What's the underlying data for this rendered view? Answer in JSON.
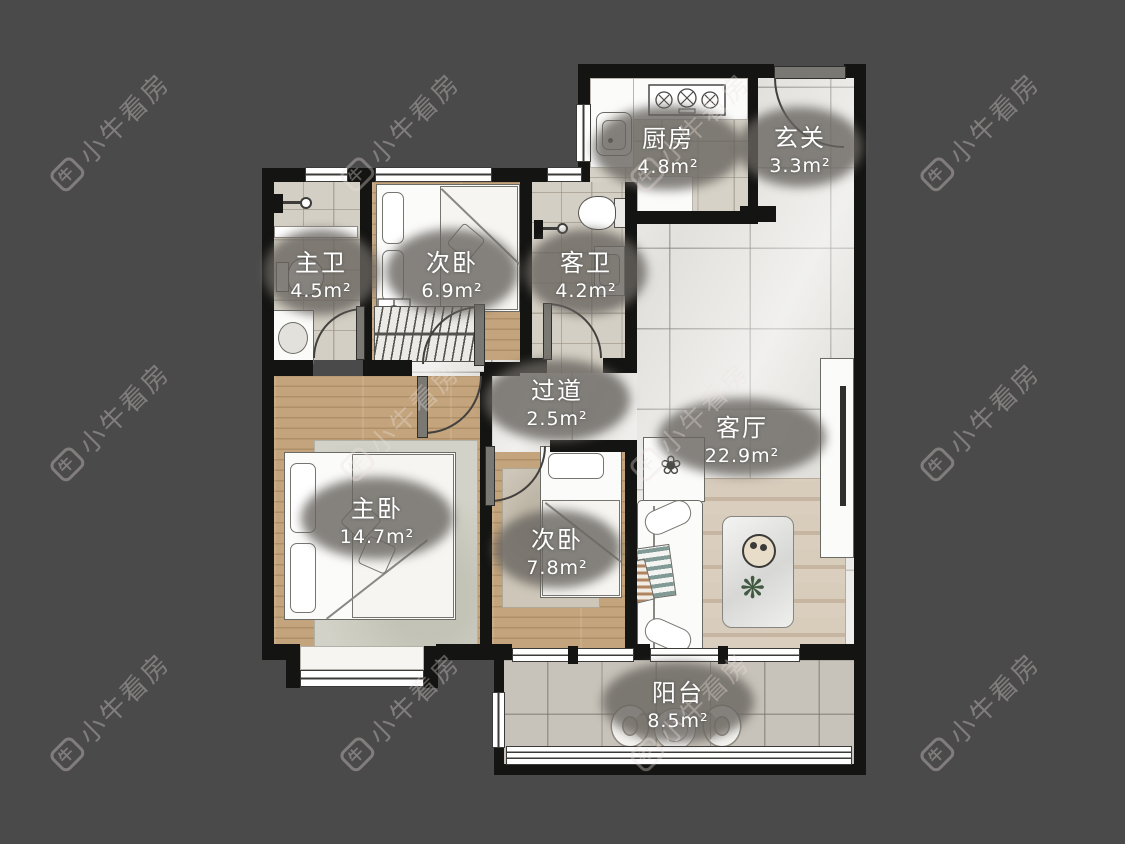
{
  "watermark": {
    "brand": "小牛看房",
    "icon_char": "牛"
  },
  "rooms": [
    {
      "id": "kitchen",
      "name": "厨房",
      "area": "4.8m²"
    },
    {
      "id": "foyer",
      "name": "玄关",
      "area": "3.3m²"
    },
    {
      "id": "master-bathroom",
      "name": "主卫",
      "area": "4.5m²"
    },
    {
      "id": "second-bedroom-north",
      "name": "次卧",
      "area": "6.9m²"
    },
    {
      "id": "guest-bathroom",
      "name": "客卫",
      "area": "4.2m²"
    },
    {
      "id": "hallway",
      "name": "过道",
      "area": "2.5m²"
    },
    {
      "id": "living-room",
      "name": "客厅",
      "area": "22.9m²"
    },
    {
      "id": "master-bedroom",
      "name": "主卧",
      "area": "14.7m²"
    },
    {
      "id": "second-bedroom",
      "name": "次卧",
      "area": "7.8m²"
    },
    {
      "id": "balcony",
      "name": "阳台",
      "area": "8.5m²"
    }
  ],
  "icons": {
    "plant_flower": "❀",
    "plant_leaf": "❋"
  },
  "colors": {
    "canvas_bg": "#4a4a4b",
    "wall": "#141412",
    "floor_marble": "#e2e1dd",
    "floor_wood": "#c3a47c",
    "floor_tile": "#d4cfc4",
    "floor_balcony": "#c8c3ba",
    "fixture_white": "#fbfbfa",
    "label_bg": "#68645f",
    "label_text": "#ffffff",
    "watermark": "#ece3df"
  }
}
